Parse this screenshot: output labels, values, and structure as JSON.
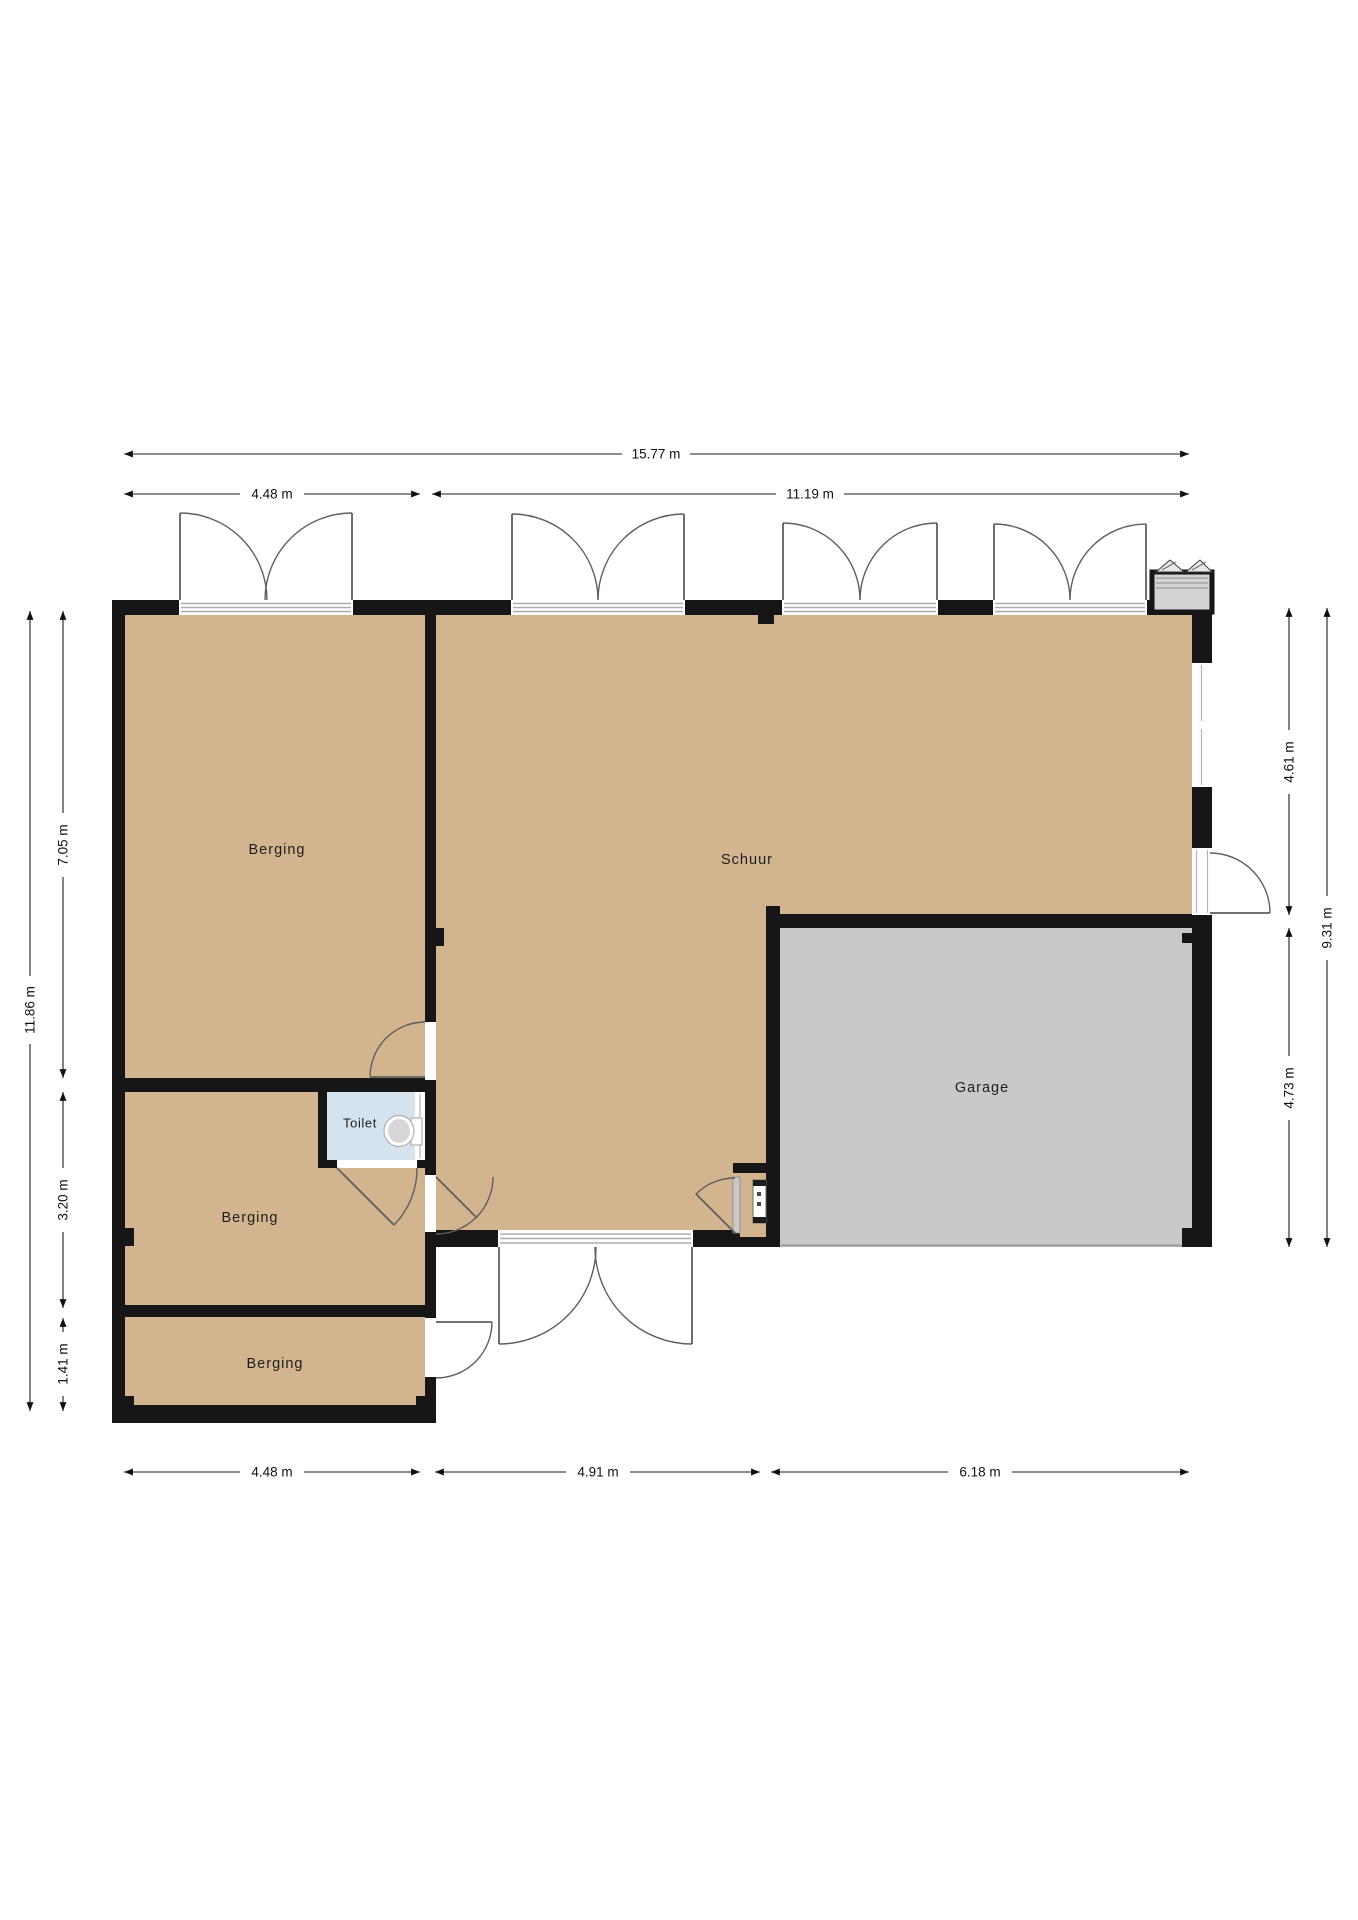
{
  "plan": {
    "rooms": {
      "berging_top": "Berging",
      "schuur": "Schuur",
      "toilet": "Toilet",
      "berging_middle": "Berging",
      "berging_bottom": "Berging",
      "garage": "Garage"
    },
    "dims": {
      "top_total": "15.77 m",
      "top_left": "4.48 m",
      "top_right": "11.19 m",
      "left_total": "11.86 m",
      "left_upper": "7.05 m",
      "left_middle": "3.20 m",
      "left_lower": "1.41 m",
      "right_upper": "4.61 m",
      "right_total": "9.31 m",
      "right_lower": "4.73 m",
      "bottom_left": "4.48 m",
      "bottom_middle": "4.91 m",
      "bottom_right": "6.18 m"
    },
    "colors": {
      "floor_wood": "#d2b48f",
      "floor_garage": "#c9c9c9",
      "floor_toilet": "#d5e3ef",
      "wall": "#161616"
    }
  }
}
